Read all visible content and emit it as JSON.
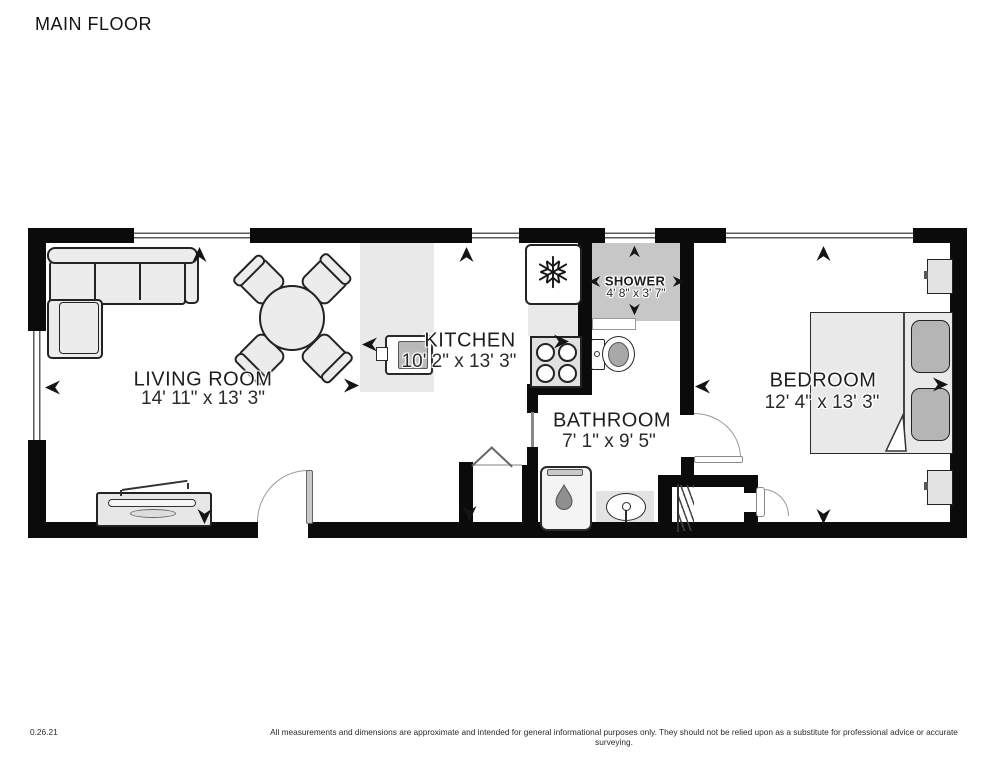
{
  "title": "MAIN FLOOR",
  "rooms": {
    "living": {
      "name": "LIVING ROOM",
      "dims": "14' 11\" x 13' 3\""
    },
    "kitchen": {
      "name": "KITCHEN",
      "dims": "10' 2\" x 13' 3\""
    },
    "shower": {
      "name": "SHOWER",
      "dims": "4' 8\" x 3' 7\""
    },
    "bathroom": {
      "name": "BATHROOM",
      "dims": "7' 1\" x 9' 5\""
    },
    "bedroom": {
      "name": "BEDROOM",
      "dims": "12' 4\" x 13' 3\""
    }
  },
  "footer": {
    "version": "0.26.21",
    "disclaimer": "All measurements and dimensions are approximate and intended for general informational purposes only. They should not be relied upon as a substitute for professional advice or accurate surveying."
  },
  "colors": {
    "wall": "#0b0b0b",
    "shower_floor": "#c7c7c7",
    "island": "#e9e9e9",
    "furniture": "#ececec",
    "pillow": "#b5b5b5"
  }
}
